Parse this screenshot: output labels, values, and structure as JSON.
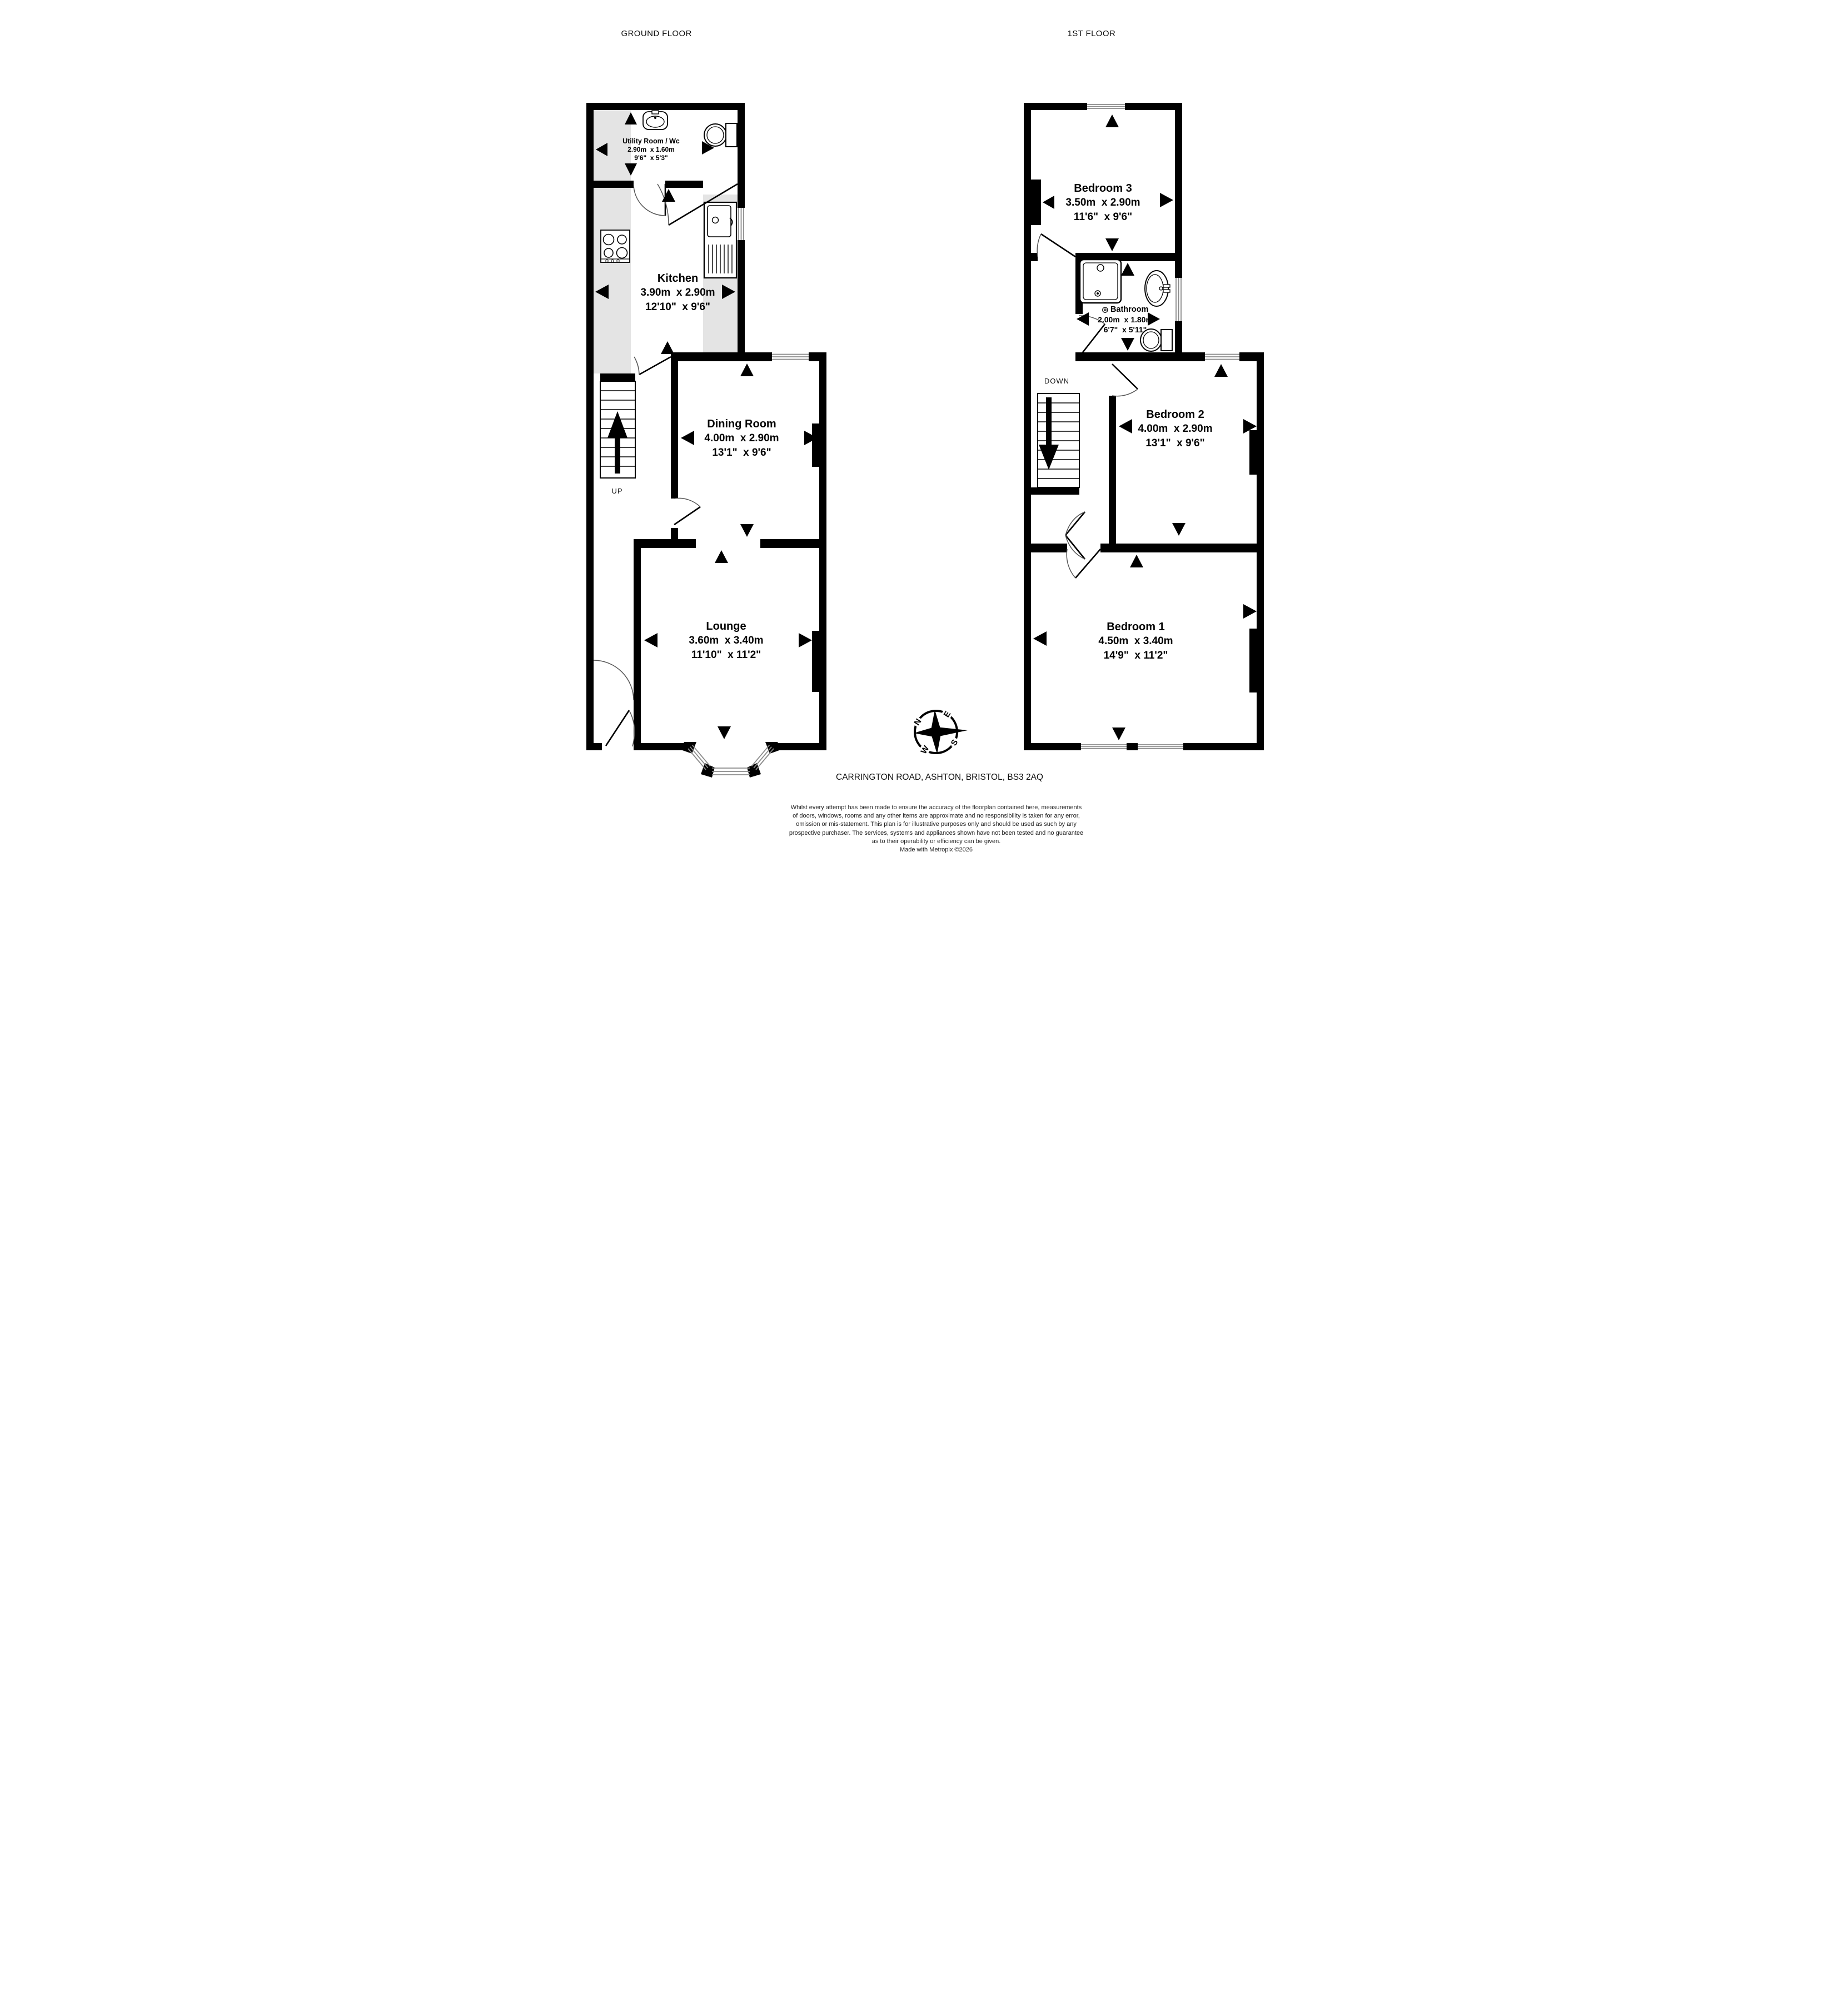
{
  "floors": [
    {
      "title": "GROUND FLOOR",
      "stair_label": "UP",
      "rooms": [
        {
          "name": "Utility Room / Wc",
          "metric": "2.90m  x 1.60m",
          "imperial": "9'6\"  x 5'3\""
        },
        {
          "name": "Kitchen",
          "metric": "3.90m  x 2.90m",
          "imperial": "12'10\"  x 9'6\""
        },
        {
          "name": "Dining Room",
          "metric": "4.00m  x 2.90m",
          "imperial": "13'1\"  x 9'6\""
        },
        {
          "name": "Lounge",
          "metric": "3.60m  x 3.40m",
          "imperial": "11'10\"  x 11'2\""
        }
      ]
    },
    {
      "title": "1ST FLOOR",
      "stair_label": "DOWN",
      "rooms": [
        {
          "name": "Bedroom 3",
          "metric": "3.50m  x 2.90m",
          "imperial": "11'6\"  x 9'6\""
        },
        {
          "name": "Bathroom",
          "metric": "2.00m  x 1.80m",
          "imperial": "6'7\"  x 5'11\""
        },
        {
          "name": "Bedroom 2",
          "metric": "4.00m  x 2.90m",
          "imperial": "13'1\"  x 9'6\""
        },
        {
          "name": "Bedroom 1",
          "metric": "4.50m  x 3.40m",
          "imperial": "14'9\"  x 11'2\""
        }
      ]
    }
  ],
  "compass": {
    "n": "N",
    "e": "E",
    "s": "S",
    "w": "W"
  },
  "icons": {
    "shower_head": "◎"
  },
  "address": "CARRINGTON ROAD, ASHTON, BRISTOL, BS3 2AQ",
  "disclaimer": [
    "Whilst every attempt has been made to ensure the accuracy of the floorplan contained here, measurements",
    "of doors, windows, rooms and any other items are approximate and no responsibility is taken for any error,",
    "omission or mis-statement. This plan is for illustrative purposes only and should be used as such by any",
    "prospective purchaser. The services, systems and appliances shown have not been tested and no guarantee",
    "as to their operability or efficiency can be given.",
    "Made with Metropix ©2026"
  ],
  "colors": {
    "wall": "#000000",
    "counter": "#e4e4e4",
    "window_line": "#8a8a8a",
    "arc": "#555555"
  }
}
